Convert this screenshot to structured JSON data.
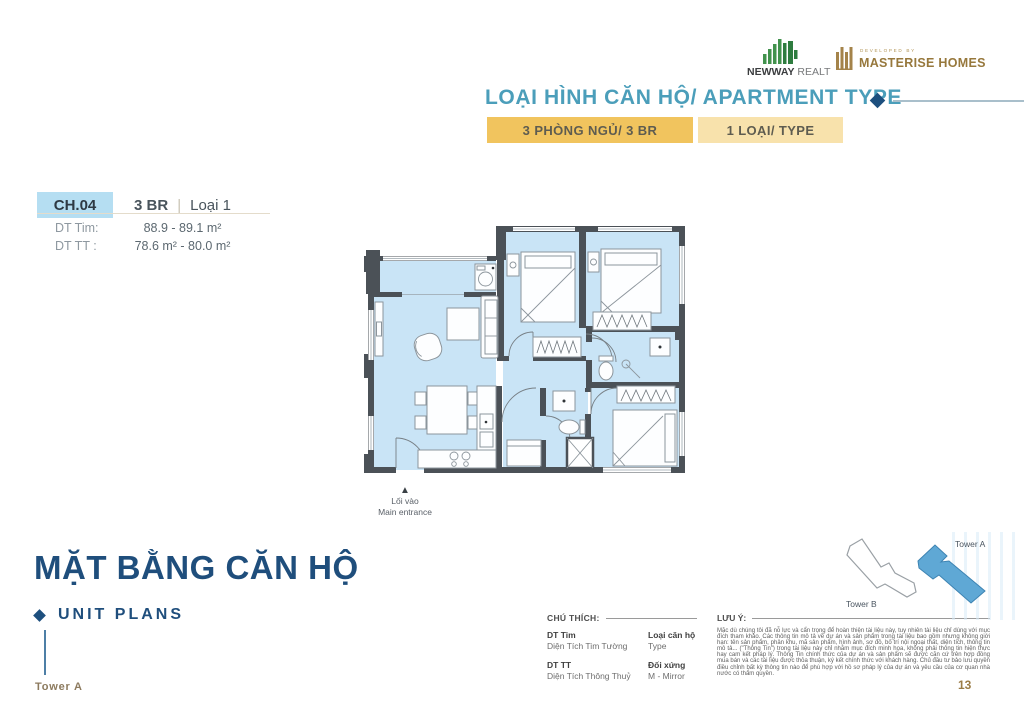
{
  "colors": {
    "accent_teal": "#4B9EBA",
    "navy": "#1F4E7C",
    "gold_tab": "#F1C45E",
    "gold_tab_light": "#F8E2AC",
    "chip_blue": "#B5DEF2",
    "plan_floor": "#C9E4F6",
    "plan_wall": "#4B5157",
    "brand_green": "#41924C",
    "brand_gold": "#97783C",
    "tower_a_fill": "#5FA8D5"
  },
  "header": {
    "newway_name": "NEWWAY",
    "newway_suffix": " REALTY",
    "developed_by": "DEVELOPED BY",
    "masterise_name": "MASTERISE HOMES",
    "title": "LOẠI HÌNH CĂN HỘ/ APARTMENT TYPE",
    "tab_primary": "3 PHÒNG NGỦ/ 3 BR",
    "tab_secondary": "1 LOẠI/ TYPE"
  },
  "unit_card": {
    "code": "CH.04",
    "type": "3 BR",
    "separator": "|",
    "variant": "Loại 1",
    "dt_tim_label": "DT Tim:",
    "dt_tim_value": "88.9 - 89.1 m²",
    "dt_tt_label": "DT TT :",
    "dt_tt_value": "78.6 m² - 80.0 m²"
  },
  "floorplan": {
    "entrance_label_vi": "Lối vào",
    "entrance_label_en": "Main entrance"
  },
  "section": {
    "title": "MẶT BẰNG CĂN HỘ",
    "subtitle": "UNIT PLANS",
    "tower_label": "Tower A"
  },
  "legend": {
    "title": "CHÚ THÍCH:",
    "items": [
      {
        "term": "DT Tim",
        "desc": "Diện Tích Tim Tường"
      },
      {
        "term": "Loại căn hộ",
        "desc": "Type"
      },
      {
        "term": "DT TT",
        "desc": "Diện Tích Thông Thuỷ"
      },
      {
        "term": "Đối xứng",
        "desc": "M - Mirror"
      }
    ]
  },
  "note": {
    "title": "LƯU Ý:",
    "body": "Mặc dù chúng tôi đã nỗ lực và cẩn trọng để hoàn thiện tài liệu này, tuy nhiên tài liệu chỉ dùng với mục đích tham khảo. Các thông tin mô tả về dự án và sản phẩm trong tài liệu bao gồm nhưng không giới hạn: tên sản phẩm, phân khu, mã sản phẩm, hình ảnh, sơ đồ, bố trí nội ngoại thất, diện tích, thông tin mô tả... (\"Thông Tin\") trong tài liệu này chỉ nhằm mục đích minh họa, không phải thông tin hiện thực hay cam kết pháp lý. Thông Tin chính thức của dự án và sản phẩm sẽ được căn cứ trên hợp đồng mua bán và các tài liệu được thỏa thuận, ký kết chính thức với khách hàng. Chủ đầu tư bảo lưu quyền điều chỉnh bất kỳ thông tin nào để phù hợp với hồ sơ pháp lý của dự án và yêu cầu của cơ quan nhà nước có thẩm quyền."
  },
  "minimap": {
    "tower_a": "Tower A",
    "tower_b": "Tower B"
  },
  "page_number": "13"
}
